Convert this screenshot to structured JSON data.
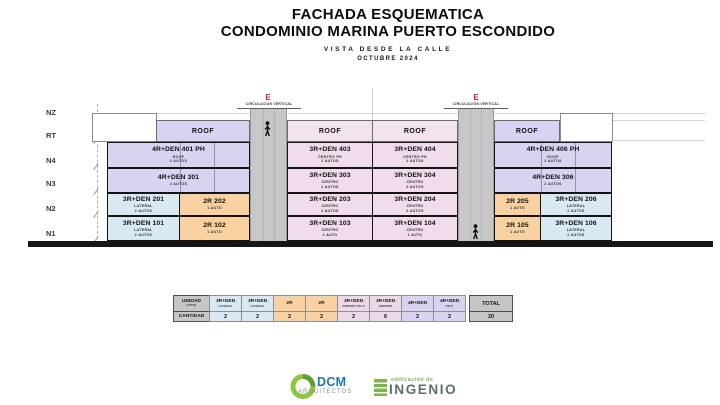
{
  "title": {
    "line1": "FACHADA ESQUEMATICA",
    "line2": "CONDOMINIO MARINA PUERTO ESCONDIDO",
    "subtitle": "VISTA DESDE LA CALLE",
    "date": "OCTUBRE 2024"
  },
  "levels": [
    "NZ",
    "RT",
    "N4",
    "N3",
    "N2",
    "N1"
  ],
  "circulation": {
    "letter": "E",
    "label": "CIRCULACION VERTICAL"
  },
  "building": {
    "roof_label": "ROOF",
    "units": {
      "u401": {
        "name": "4R+DEN 401 PH",
        "l1": "ROOF",
        "l2": "2 AUTOS"
      },
      "u301": {
        "name": "4R+DEN 301",
        "l1": "2 AUTOS",
        "l2": ""
      },
      "u201": {
        "name": "3R+DEN 201",
        "l1": "LATERAL",
        "l2": "2 AUTOS"
      },
      "u202": {
        "name": "2R 202",
        "l1": "1 AUTO",
        "l2": ""
      },
      "u101": {
        "name": "3R+DEN 101",
        "l1": "LATERAL",
        "l2": "2 AUTOS"
      },
      "u102": {
        "name": "2R 102",
        "l1": "1 AUTO",
        "l2": ""
      },
      "u403": {
        "name": "3R+DEN 403",
        "l1": "CENTRO PH",
        "l2": "2 AUTOS"
      },
      "u404": {
        "name": "3R+DEN 404",
        "l1": "CENTRO PH",
        "l2": "2 AUTOS"
      },
      "u303": {
        "name": "3R+DEN 303",
        "l1": "CENTRO",
        "l2": "2 AUTOS"
      },
      "u304": {
        "name": "3R+DEN 304",
        "l1": "CENTRO",
        "l2": "2 AUTOS"
      },
      "u203": {
        "name": "3R+DEN 203",
        "l1": "CENTRO",
        "l2": "2 AUTOS"
      },
      "u204": {
        "name": "3R+DEN 204",
        "l1": "CENTRO",
        "l2": "2 AUTOS"
      },
      "u103": {
        "name": "3R+DEN 103",
        "l1": "CENTRO",
        "l2": "1 AUTO"
      },
      "u104": {
        "name": "3R+DEN 104",
        "l1": "CENTRO",
        "l2": "1 AUTO"
      },
      "u406": {
        "name": "4R+DEN 406 PH",
        "l1": "ROOF",
        "l2": "2 AUTOS"
      },
      "u306": {
        "name": "4R+DEN 306",
        "l1": "2 AUTOS",
        "l2": ""
      },
      "u205": {
        "name": "2R 205",
        "l1": "1 AUTO",
        "l2": ""
      },
      "u206": {
        "name": "3R+DEN 206",
        "l1": "LATERAL",
        "l2": "2 AUTOS"
      },
      "u105": {
        "name": "2R 105",
        "l1": "1 AUTO",
        "l2": ""
      },
      "u106": {
        "name": "3R+DEN 106",
        "l1": "LATERAL",
        "l2": "2 AUTOS"
      }
    }
  },
  "table": {
    "header_label": {
      "main": "UNIDAD",
      "sub": "(TIPO)"
    },
    "row_label": "CANTIDAD",
    "total_header": "TOTAL",
    "total_value": "20",
    "columns": [
      {
        "main": "3R+DEN",
        "sub": "LATERAL",
        "count": "2"
      },
      {
        "main": "3R+DEN",
        "sub": "LATERAL",
        "count": "2"
      },
      {
        "main": "2R",
        "sub": "",
        "count": "2"
      },
      {
        "main": "2R",
        "sub": "",
        "count": "2"
      },
      {
        "main": "3R+DEN",
        "sub": "CENTRO PH'S",
        "count": "2"
      },
      {
        "main": "3R+DEN",
        "sub": "CENTRO",
        "count": "6"
      },
      {
        "main": "4R+DEN",
        "sub": "",
        "count": "2"
      },
      {
        "main": "4R+DEN",
        "sub": "PH'S",
        "count": "2"
      }
    ]
  },
  "logos": {
    "dcm": {
      "name": "DCM",
      "sub": "ARQUITECTOS"
    },
    "ingenio": {
      "top": "edificación de",
      "name": "INGENIO"
    }
  },
  "colors": {
    "lavender": "#d9d2f0",
    "pink_unit": "#f0dcea",
    "pink_roof": "#f3e3ee",
    "blue": "#d8e9f3",
    "orange": "#fad2a2",
    "tower_gray": "#c7c7c7",
    "table_gray": "#c6c6c6",
    "accent_red": "#cc2222",
    "logo_green": "#7ab648",
    "dcm_blue": "#1b75bb"
  }
}
